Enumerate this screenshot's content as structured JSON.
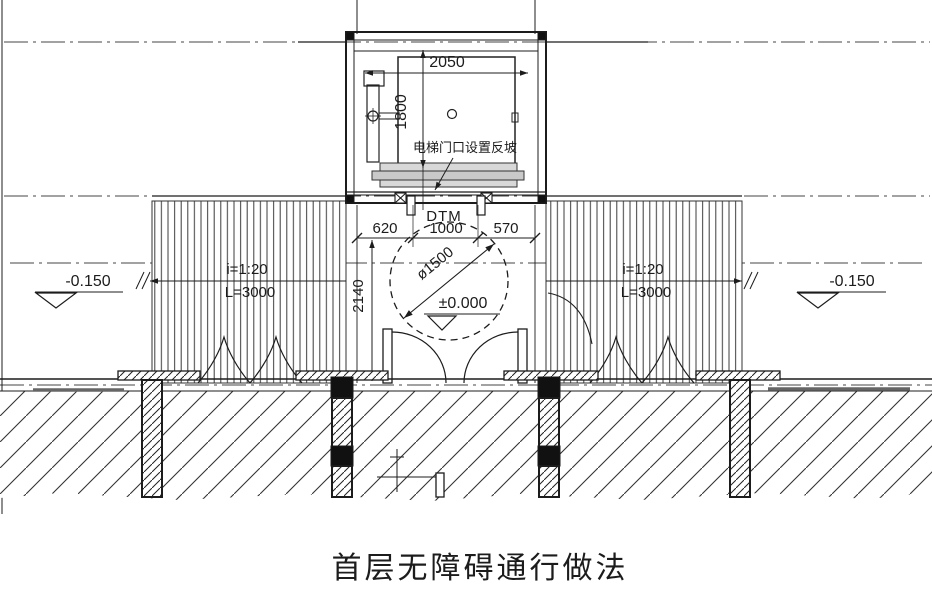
{
  "drawing": {
    "title": "首层无障碍通行做法",
    "elevator": {
      "width_dim": "2050",
      "depth_dim": "1800",
      "door_note": "电梯门口设置反坡",
      "door_label": "DTM"
    },
    "entrance": {
      "dim_left": "620",
      "dim_center": "1000",
      "dim_right": "570",
      "depth_dim": "2140",
      "turning_circle_dim": "ø1500",
      "floor_level": "±0.000"
    },
    "ramp_left": {
      "slope": "i=1:20",
      "length": "L=3000",
      "level": "-0.150"
    },
    "ramp_right": {
      "slope": "i=1:20",
      "length": "L=3000",
      "level": "-0.150"
    },
    "colors": {
      "line": "#1c1c1c",
      "axis": "#444444",
      "gray_fill": "#d0d0d0"
    }
  }
}
